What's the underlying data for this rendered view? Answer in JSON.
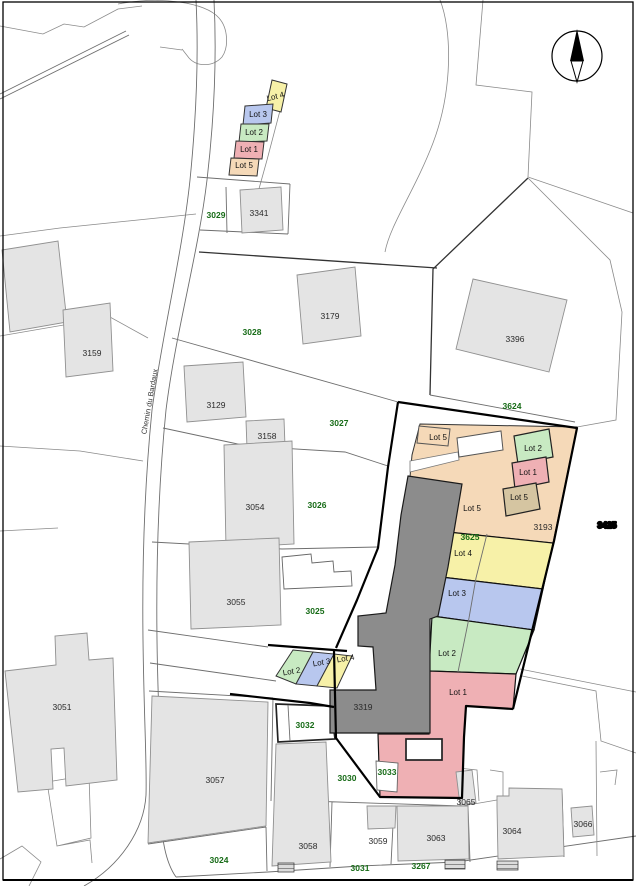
{
  "map_title": "cadastral-parcel-plan",
  "road": {
    "name": "Chemin du Bardaux"
  },
  "compass": {
    "name": "north-arrow"
  },
  "labels": {
    "black": [
      "3341",
      "3159",
      "3179",
      "3396",
      "3129",
      "3158",
      "3054",
      "3055",
      "3051",
      "3057",
      "3058",
      "3059",
      "3063",
      "3064",
      "3065",
      "3066",
      "3319",
      "3193",
      "3425"
    ],
    "green": [
      "3029",
      "3028",
      "3027",
      "3026",
      "3025",
      "3024",
      "3030",
      "3031",
      "3032",
      "3033",
      "3267",
      "3624",
      "3625"
    ],
    "lots_top": [
      "Lot 4",
      "Lot 3",
      "Lot 2",
      "Lot 1",
      "Lot 5"
    ],
    "lots_main": [
      "Lot 5",
      "Lot 2",
      "Lot 1",
      "Lot 5",
      "Lot 5",
      "Lot 4",
      "Lot 3",
      "Lot 2",
      "Lot 1"
    ],
    "lots_mid": [
      "Lot 2",
      "Lot 3",
      "Lot 4"
    ]
  },
  "colors": {
    "lot_yellow": "#f7f1a8",
    "lot_blue": "#b8c7ee",
    "lot_green": "#c8eac2",
    "lot_pink": "#efb0b4",
    "lot_orange": "#f5d9b8",
    "lot_tan": "#d5c5a1",
    "building_light": "#e4e4e4",
    "building_dark": "#8c8c8c",
    "green_label_text": "#166b16",
    "black_label_text": "#2a2a2a",
    "boundary_bold": "#000000"
  }
}
